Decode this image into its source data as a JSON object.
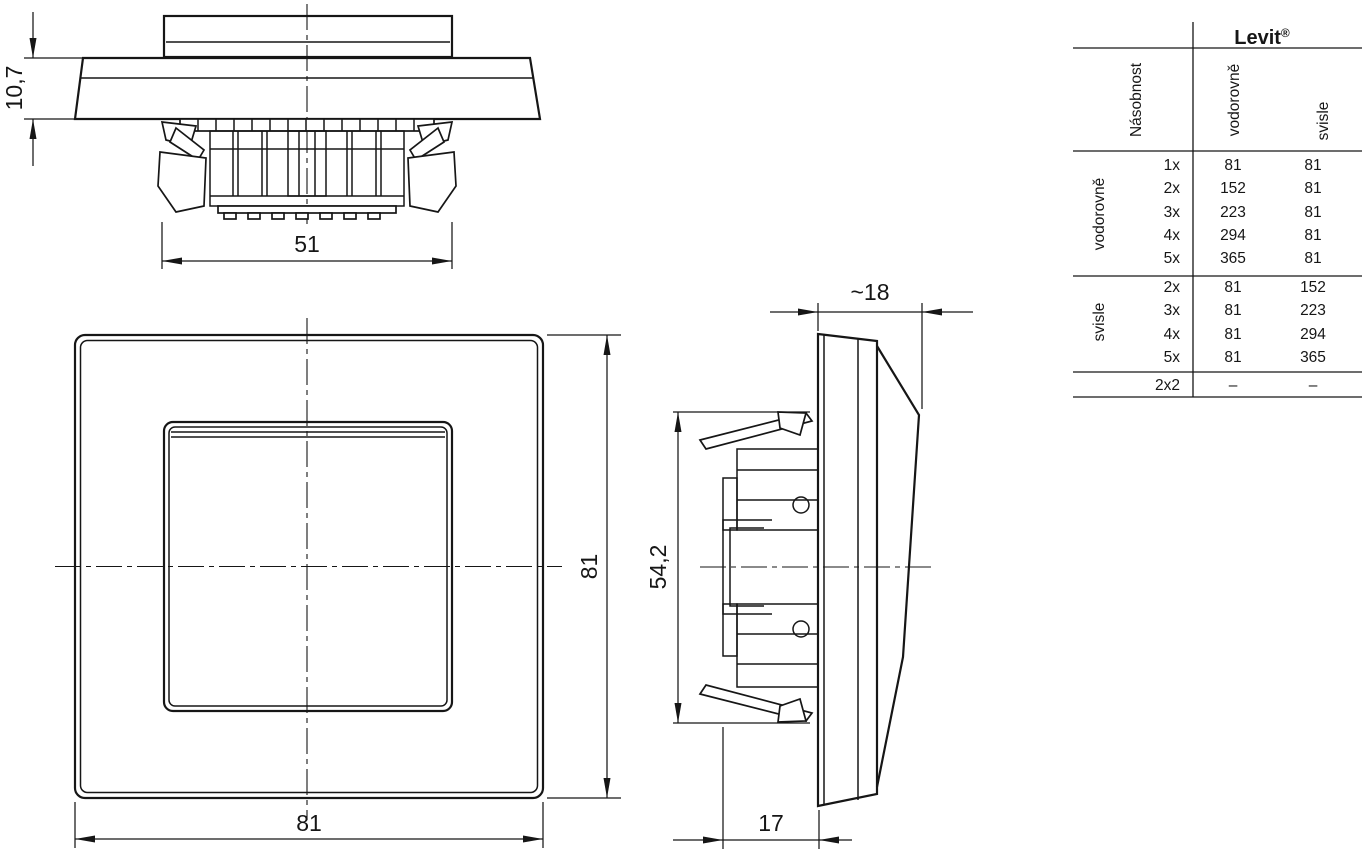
{
  "views": {
    "top": {
      "height_label": "10,7",
      "width_label": "51"
    },
    "front": {
      "width_label": "81",
      "height_label": "81"
    },
    "side": {
      "depth_front_label": "~18",
      "height_label": "54,2",
      "depth_back_label": "17"
    }
  },
  "table": {
    "brand": "Levit",
    "brand_reg": "®",
    "multiplicity_header": "Násobnost",
    "orientation_headers": {
      "horizontal": "vodorovně",
      "vertical": "svisle"
    },
    "groups": [
      {
        "label": "vodorovně",
        "rows": [
          [
            "1x",
            "81",
            "81"
          ],
          [
            "2x",
            "152",
            "81"
          ],
          [
            "3x",
            "223",
            "81"
          ],
          [
            "4x",
            "294",
            "81"
          ],
          [
            "5x",
            "365",
            "81"
          ]
        ]
      },
      {
        "label": "svisle",
        "rows": [
          [
            "2x",
            "81",
            "152"
          ],
          [
            "3x",
            "81",
            "223"
          ],
          [
            "4x",
            "81",
            "294"
          ],
          [
            "5x",
            "81",
            "365"
          ]
        ]
      }
    ],
    "footer_row": [
      "2x2",
      "–",
      "–"
    ]
  },
  "colors": {
    "line": "#161616",
    "background": "#ffffff"
  }
}
